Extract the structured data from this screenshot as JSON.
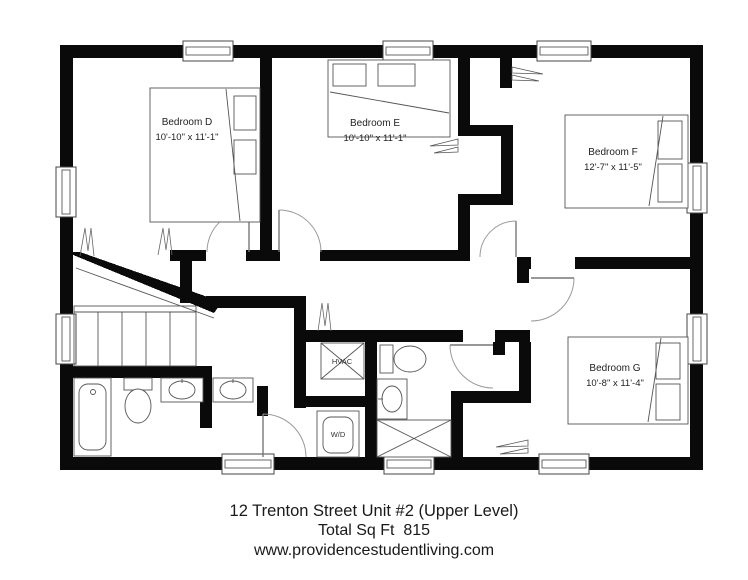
{
  "rooms": [
    {
      "name": "Bedroom D",
      "dims": "10'-10\" x 11'-1\""
    },
    {
      "name": "Bedroom E",
      "dims": "10'-10\" x 11'-1\""
    },
    {
      "name": "Bedroom F",
      "dims": "12'-7\" x 11'-5\""
    },
    {
      "name": "Bedroom G",
      "dims": "10'-8\" x 11'-4\""
    }
  ],
  "utilities": {
    "hvac": "HVAC",
    "washer_dryer": "W/D"
  },
  "caption": {
    "address": "12 Trenton Street Unit #2 (Upper Level)",
    "sqft": "Total Sq Ft  815",
    "website": "www.providencestudentliving.com"
  },
  "colors": {
    "wall": "#0a0a0a",
    "line": "#555555",
    "background": "#ffffff"
  }
}
